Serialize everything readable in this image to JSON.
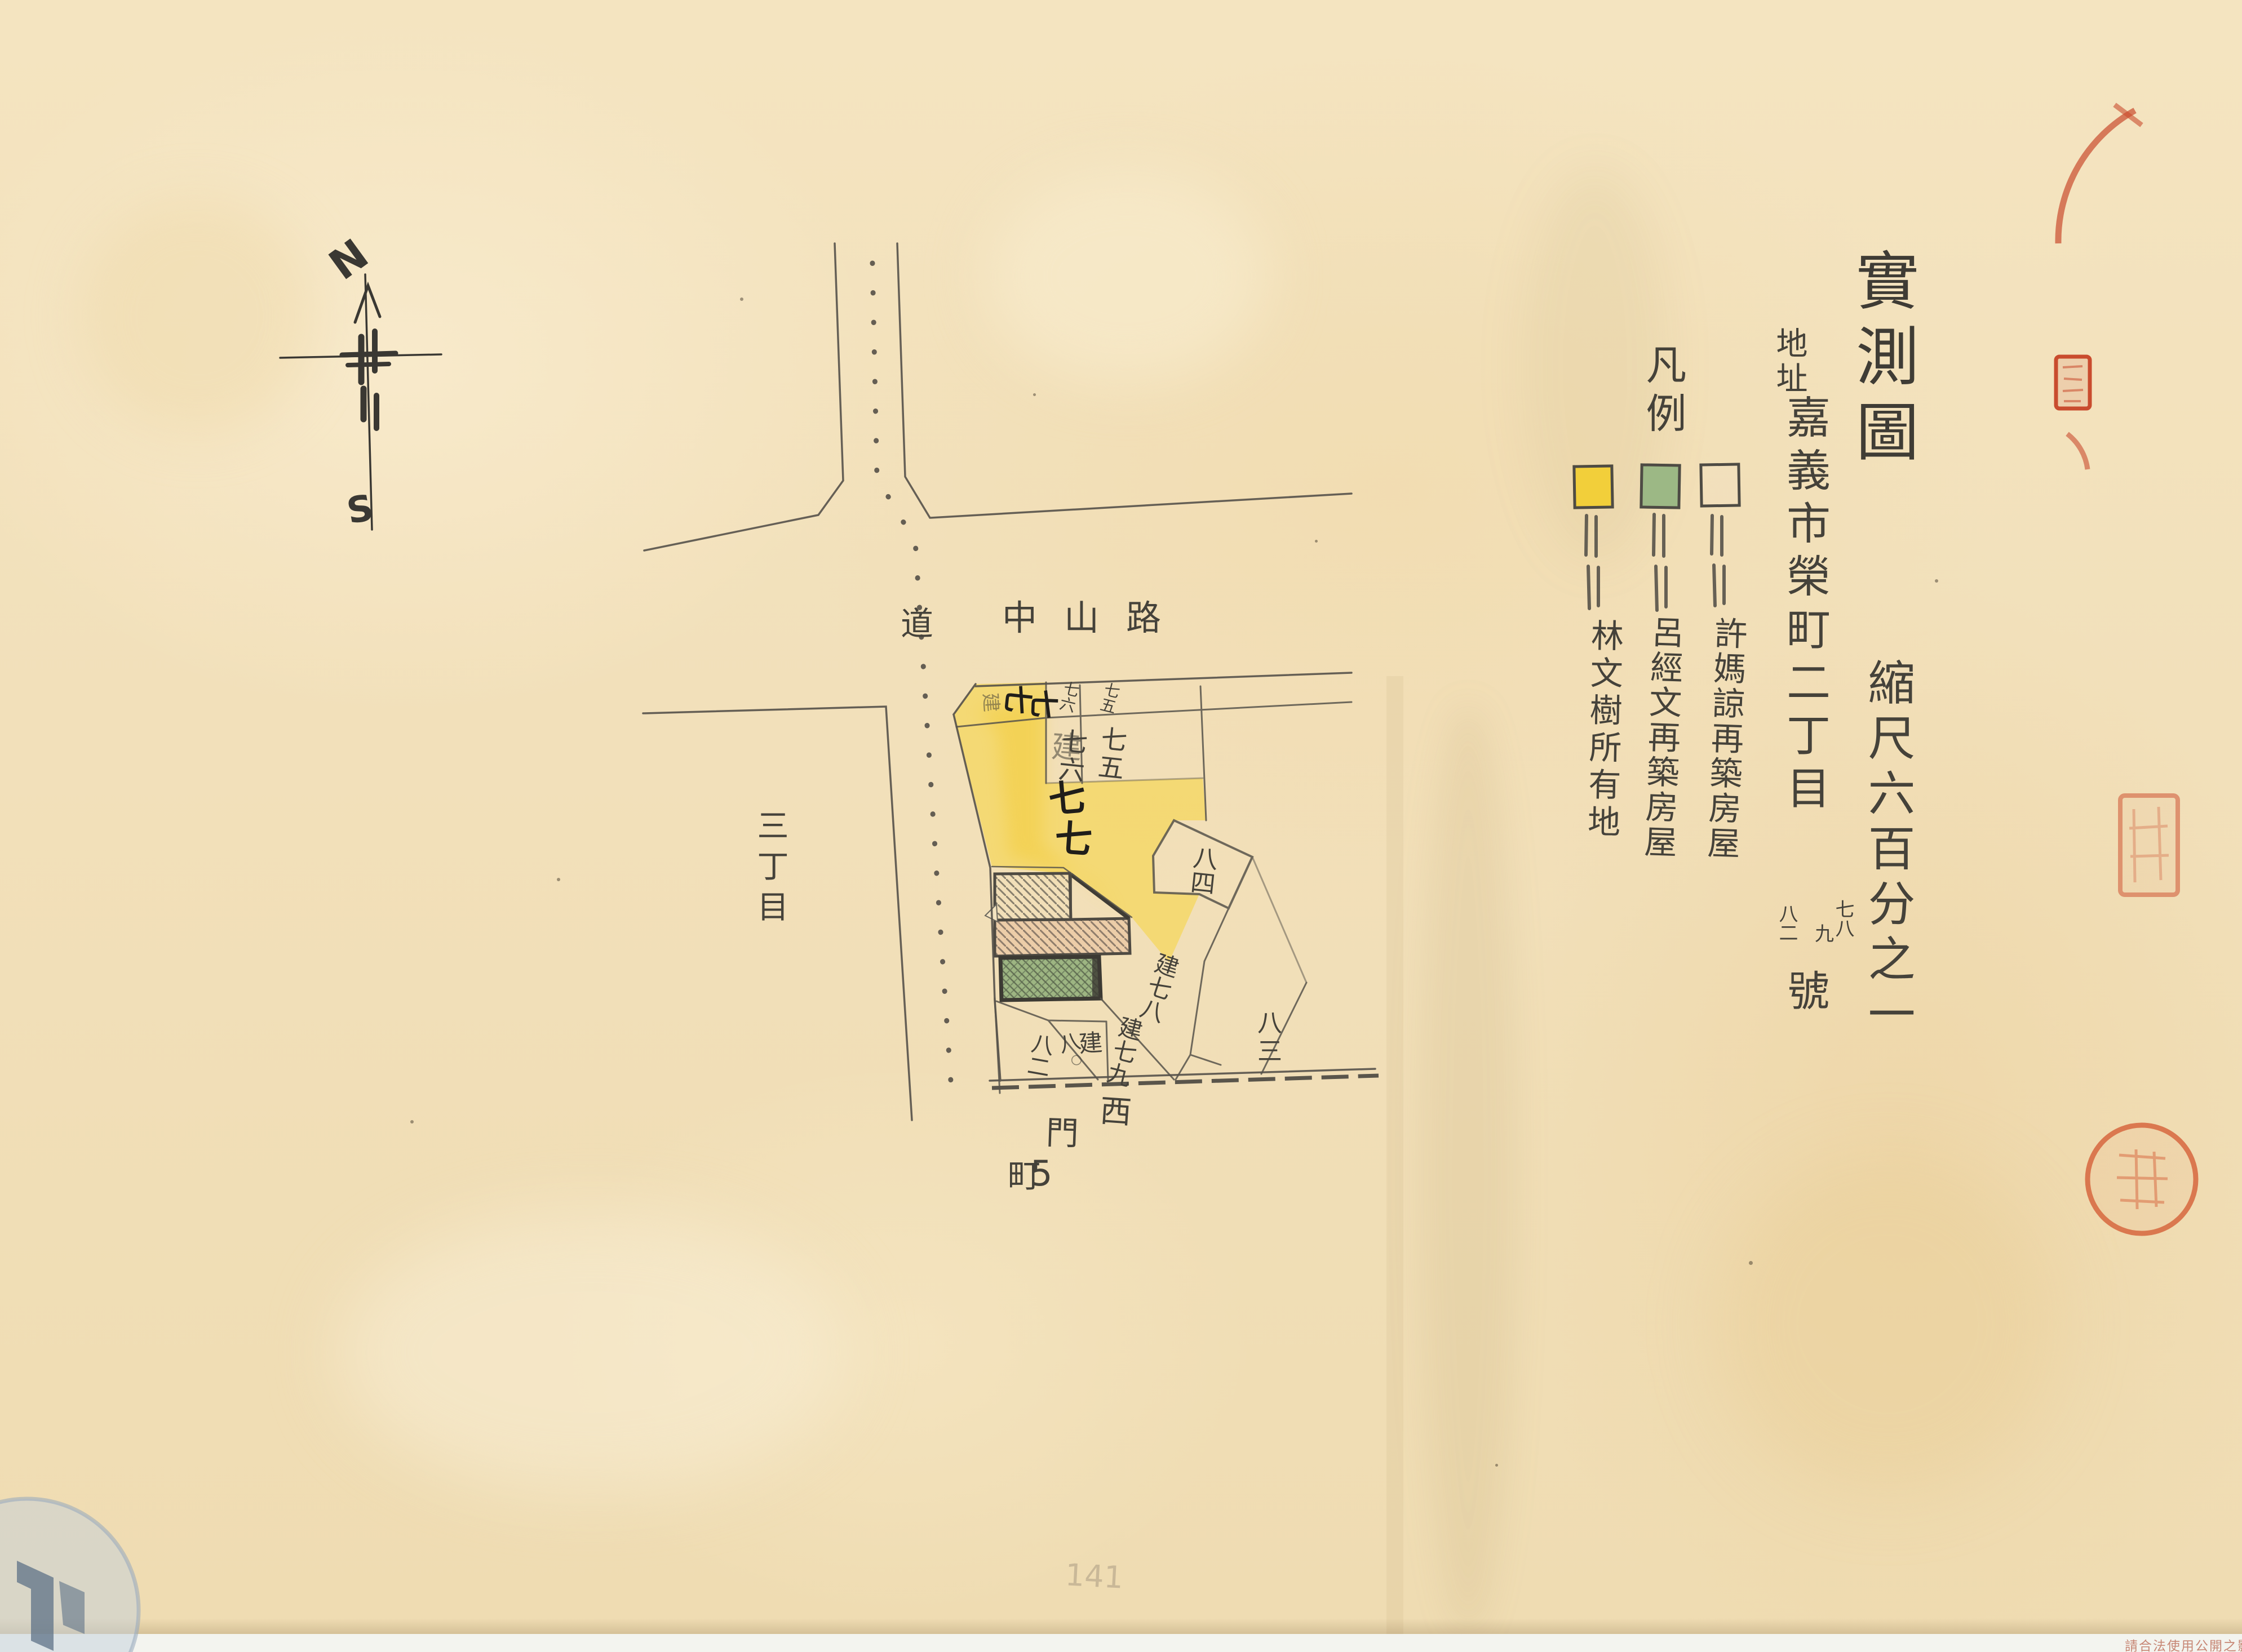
{
  "document": {
    "type_note": "hand-drawn cadastral survey sketch on aged paper",
    "watermark_text": "請合法使用公開之影像",
    "faint_pencil_number": "141"
  },
  "title_block": {
    "title": "實測圖",
    "scale": "縮尺六百分之一",
    "address_label": "地址",
    "address_main": "嘉義市榮町二丁目",
    "address_numbers": [
      "七八",
      "九",
      "八二"
    ],
    "address_suffix": "號"
  },
  "legend": {
    "heading": "凡例",
    "items": [
      {
        "swatch": "yellow-square",
        "color": "#f2cf3a",
        "label": "林文樹所有地"
      },
      {
        "swatch": "green-square",
        "color": "#9cb885",
        "label": "呂經文再築房屋"
      },
      {
        "swatch": "white-square",
        "color": "",
        "label": "許媽諒再築房屋"
      }
    ]
  },
  "map": {
    "road_vertical_label": "道",
    "road_horizontal_label": "中山路",
    "district_label": "三丁目",
    "street_chars": [
      "西",
      "門",
      "町",
      "5"
    ],
    "strip_77": [
      "建",
      "七",
      "七"
    ],
    "lot_77": [
      "建",
      "七",
      "七"
    ],
    "strip_76": "七六",
    "strip_75": "七五",
    "lot_76": "七六",
    "lot_75": "七五",
    "lot_84": "八四",
    "lot_78": "建七八",
    "lot_79": "建七九",
    "lot_80": [
      "八",
      "建",
      "〇"
    ],
    "lot_82": "八二",
    "lot_83": "八三"
  },
  "north_arrow": {
    "north": "N",
    "south": "S"
  },
  "colors": {
    "pencil": "#45423a",
    "lot77_yellow": "#f6d33c",
    "building_green": "#93b07c",
    "building_pink": "#e2a284",
    "seal_red": "#c94c2e"
  }
}
